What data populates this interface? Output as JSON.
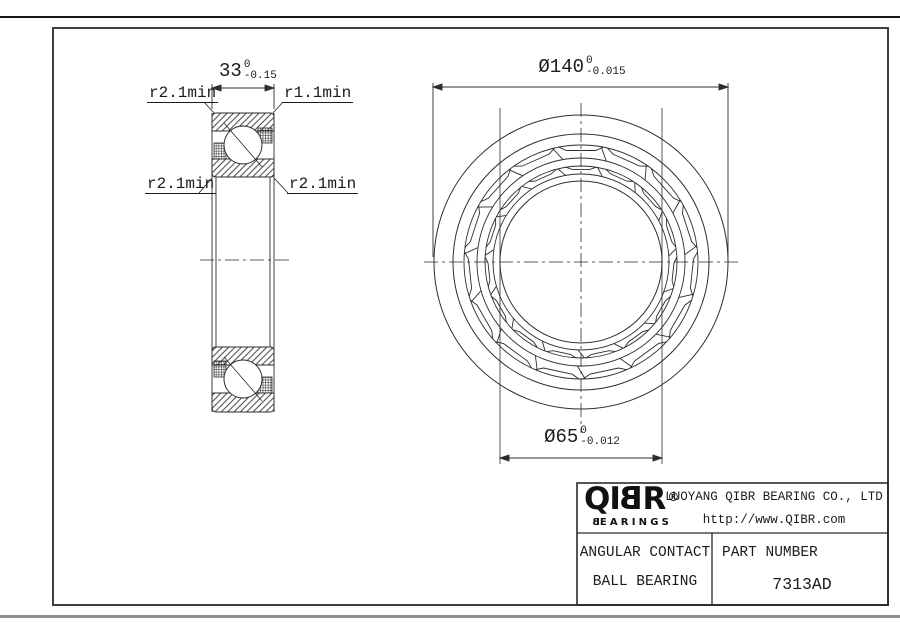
{
  "section_view": {
    "width_dim": {
      "value": "33",
      "upper_tol": "0",
      "lower_tol": "-0.15"
    },
    "labels": {
      "top_left": "r2.1min",
      "top_right": "r1.1min",
      "mid_left": "r2.1min",
      "mid_right": "r2.1min"
    }
  },
  "front_view": {
    "outer_dim": {
      "value": "Ø140",
      "upper_tol": "0",
      "lower_tol": "-0.015"
    },
    "bore_dim": {
      "value": "Ø65",
      "upper_tol": "0",
      "lower_tol": "-0.012"
    }
  },
  "title_block": {
    "logo": {
      "letters": [
        "Q",
        "I",
        "B",
        "R"
      ],
      "registered": "®",
      "sub_b": "B",
      "sub_rest": "EARINGS"
    },
    "company": "LUOYANG QIBR BEARING CO., LTD",
    "website": "http://www.QIBR.com",
    "product_line1": "ANGULAR CONTACT",
    "product_line2": "BALL BEARING",
    "part_label": "PART NUMBER",
    "part_number": "7313AD"
  }
}
